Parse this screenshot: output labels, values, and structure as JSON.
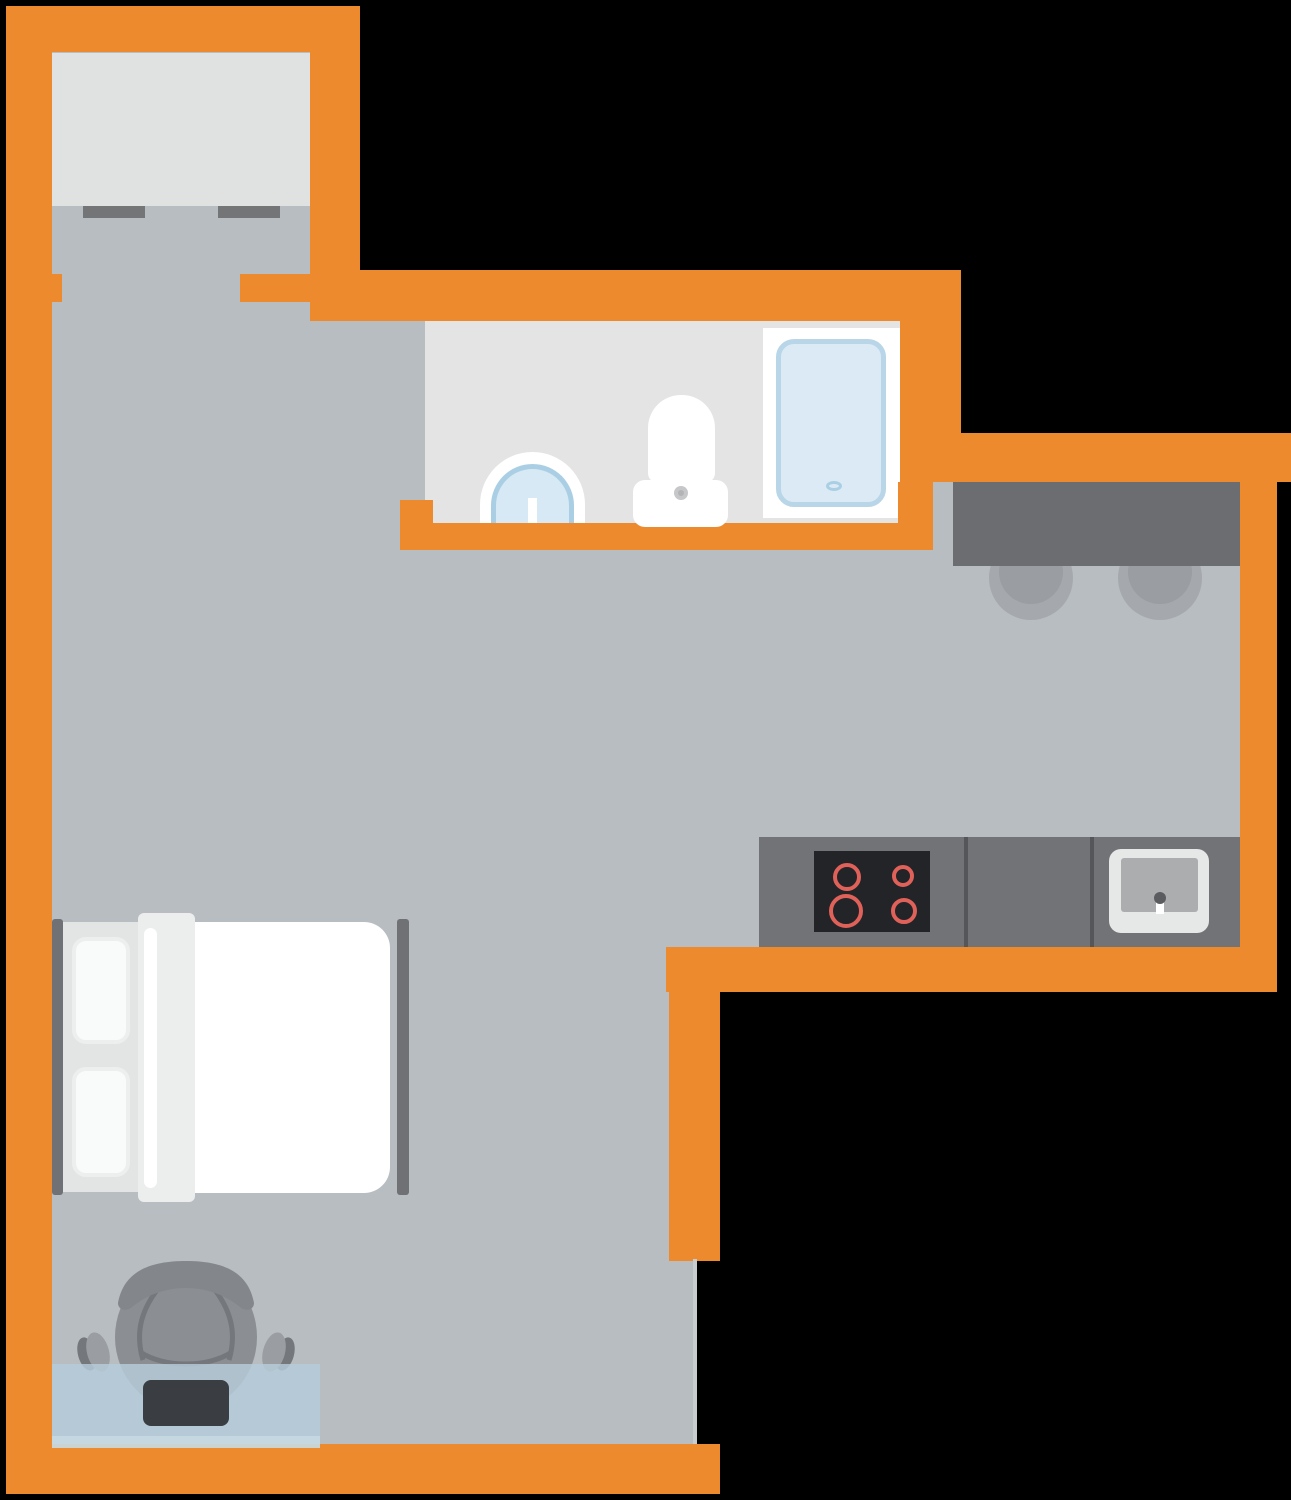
{
  "meta": {
    "title": "studio-apartment-floor-plan",
    "rooms": [
      "entry-closet",
      "living-room",
      "bathroom",
      "kitchen"
    ],
    "furniture": [
      "wardrobe",
      "double-bed",
      "desk",
      "office-chair",
      "laptop",
      "breakfast-bar",
      "bar-stool",
      "bar-stool",
      "kitchen-counter",
      "stove",
      "kitchen-sink",
      "bathroom-sink",
      "toilet",
      "shower"
    ]
  },
  "palette": {
    "wall": "#ED8A2E",
    "floor": "#B8BDC2",
    "bathroom_floor": "#E4E4E4",
    "wardrobe": "#E0E1E1",
    "handle": "#737577",
    "breakfast_bar": "#6B6D70",
    "counter": "#717376",
    "counter_divider": "#54565A",
    "stove": "#222427",
    "burner": "#DF6159",
    "sink_white": "#E6E7E7",
    "basin": "#ACADAF",
    "fixture_white": "#FFFFFF",
    "shower_border": "#B8D6E8",
    "shower_fill": "#DBEAF5",
    "blue_fill": "#D6E9F4",
    "blue_border": "#AACFE4",
    "bed_rail": "#6F7174",
    "sheet": "#E3E4E4",
    "pillow": "#F9FAFA",
    "fold_band": "#ECEDED",
    "desk": "rgba(182,204,218,0.82)",
    "desk_edge": "rgba(199,217,228,0.9)",
    "laptop": "#3A3E42",
    "chair_body": "#8B8E92",
    "chair_dark": "#74777B",
    "chair_headrest": "#83868A",
    "stool_outer": "#A5A9AD",
    "stool_inner": "#9A9EA2",
    "threshold": "#CACDD0",
    "outside": "#000000"
  },
  "scene_bg": [
    {
      "n": "floor-entry",
      "t": "rect",
      "x": 52,
      "y": 52,
      "w": 258,
      "h": 250,
      "f": "#B8BDC2"
    },
    {
      "n": "floor-living",
      "t": "rect",
      "x": 52,
      "y": 302,
      "w": 641,
      "h": 1142,
      "f": "#B8BDC2"
    },
    {
      "n": "floor-bath-corridor",
      "t": "rect",
      "x": 360,
      "y": 321,
      "w": 65,
      "h": 229,
      "f": "#B8BDC2"
    },
    {
      "n": "floor-kitchen",
      "t": "rect",
      "x": 360,
      "y": 550,
      "w": 880,
      "h": 397,
      "f": "#B8BDC2"
    },
    {
      "n": "floor-kitchen-upper",
      "t": "rect",
      "x": 900,
      "y": 482,
      "w": 340,
      "h": 68,
      "f": "#B8BDC2"
    },
    {
      "n": "bathroom-floor",
      "t": "rect",
      "x": 425,
      "y": 321,
      "w": 475,
      "h": 202,
      "f": "#E4E4E4"
    },
    {
      "n": "shower-frame",
      "t": "rect",
      "x": 763,
      "y": 328,
      "w": 137,
      "h": 190,
      "f": "#FFFFFF"
    },
    {
      "n": "shower-tray",
      "t": "rect",
      "x": 776,
      "y": 339,
      "w": 110,
      "h": 168,
      "f": "#DBEAF5",
      "b": "5px solid #B8D6E8",
      "r": "18px"
    },
    {
      "n": "shower-drain",
      "t": "rect",
      "x": 826,
      "y": 481,
      "w": 16,
      "h": 10,
      "f": "#DBEAF5",
      "b": "3px solid #AACFE4",
      "r": "50%"
    },
    {
      "n": "wardrobe",
      "t": "rect",
      "x": 52,
      "y": 53,
      "w": 258,
      "h": 153,
      "f": "#E0E1E1"
    },
    {
      "n": "wall-top",
      "t": "rect",
      "x": 6,
      "y": 6,
      "w": 354,
      "h": 46,
      "f": "#ED8A2E"
    },
    {
      "n": "wall-left",
      "t": "rect",
      "x": 6,
      "y": 6,
      "w": 46,
      "h": 1488,
      "f": "#ED8A2E"
    },
    {
      "n": "wall-bottom",
      "t": "rect",
      "x": 6,
      "y": 1444,
      "w": 714,
      "h": 50,
      "f": "#ED8A2E"
    },
    {
      "n": "wall-entry-right",
      "t": "rect",
      "x": 310,
      "y": 6,
      "w": 50,
      "h": 266,
      "f": "#ED8A2E"
    },
    {
      "n": "wall-bathroom-top",
      "t": "rect",
      "x": 310,
      "y": 270,
      "w": 651,
      "h": 51,
      "f": "#ED8A2E"
    },
    {
      "n": "door-jamb-left",
      "t": "rect",
      "x": 52,
      "y": 274,
      "w": 10,
      "h": 28,
      "f": "#ED8A2E"
    },
    {
      "n": "door-jamb-entry",
      "t": "rect",
      "x": 240,
      "y": 274,
      "w": 70,
      "h": 28,
      "f": "#ED8A2E"
    },
    {
      "n": "wall-bathroom-right",
      "t": "rect",
      "x": 900,
      "y": 271,
      "w": 61,
      "h": 211,
      "f": "#ED8A2E"
    },
    {
      "n": "wall-kitchen-top",
      "t": "rect",
      "x": 900,
      "y": 433,
      "w": 391,
      "h": 49,
      "f": "#ED8A2E"
    },
    {
      "n": "wall-bathroom-pillar",
      "t": "rect",
      "x": 898,
      "y": 482,
      "w": 35,
      "h": 68,
      "f": "#ED8A2E"
    },
    {
      "n": "door-jamb-bathroom",
      "t": "rect",
      "x": 400,
      "y": 500,
      "w": 33,
      "h": 50,
      "f": "#ED8A2E"
    },
    {
      "n": "wall-bathroom-bottom",
      "t": "rect",
      "x": 400,
      "y": 523,
      "w": 533,
      "h": 27,
      "f": "#ED8A2E"
    },
    {
      "n": "wall-kitchen-right",
      "t": "rect",
      "x": 1240,
      "y": 482,
      "w": 37,
      "h": 510,
      "f": "#ED8A2E"
    },
    {
      "n": "wall-kitchen-bottom",
      "t": "rect",
      "x": 666,
      "y": 947,
      "w": 611,
      "h": 45,
      "f": "#ED8A2E"
    },
    {
      "n": "wall-living-right",
      "t": "rect",
      "x": 669,
      "y": 947,
      "w": 51,
      "h": 314,
      "f": "#ED8A2E"
    },
    {
      "n": "entry-door-threshold",
      "t": "rect",
      "x": 693,
      "y": 1259,
      "w": 4,
      "h": 185,
      "f": "#CACDD0"
    },
    {
      "n": "wardrobe-handle-left",
      "t": "rect",
      "x": 83,
      "y": 206,
      "w": 62,
      "h": 12,
      "f": "#737577"
    },
    {
      "n": "wardrobe-handle-right",
      "t": "rect",
      "x": 218,
      "y": 206,
      "w": 62,
      "h": 12,
      "f": "#737577"
    },
    {
      "n": "bed-rail-left",
      "t": "rect",
      "x": 52,
      "y": 919,
      "w": 11,
      "h": 276,
      "f": "#6F7174",
      "r": "3px"
    },
    {
      "n": "bed-sheet",
      "t": "rect",
      "x": 63,
      "y": 922,
      "w": 75,
      "h": 270,
      "f": "#E3E4E4"
    },
    {
      "n": "bed-pillow-top",
      "t": "rect",
      "x": 72,
      "y": 937,
      "w": 58,
      "h": 107,
      "f": "#F9FAFA",
      "b": "4px solid #EDEEEE",
      "r": "14px"
    },
    {
      "n": "bed-pillow-bottom",
      "t": "rect",
      "x": 72,
      "y": 1067,
      "w": 58,
      "h": 110,
      "f": "#F9FAFA",
      "b": "4px solid #EDEEEE",
      "r": "14px"
    },
    {
      "n": "bed-mattress",
      "t": "rect",
      "x": 195,
      "y": 922,
      "w": 195,
      "h": 271,
      "f": "#FFFFFF",
      "r": "0 26px 26px 0"
    },
    {
      "n": "bed-fold-band",
      "t": "rect",
      "x": 138,
      "y": 913,
      "w": 57,
      "h": 289,
      "f": "#ECEDED",
      "r": "6px"
    },
    {
      "n": "bed-fold-stripe",
      "t": "rect",
      "x": 144,
      "y": 928,
      "w": 13,
      "h": 260,
      "f": "#FFFFFF",
      "r": "7px"
    },
    {
      "n": "bed-rail-right",
      "t": "rect",
      "x": 397,
      "y": 919,
      "w": 12,
      "h": 276,
      "f": "#6F7174",
      "r": "3px"
    }
  ],
  "scene_fg": [
    {
      "n": "desk",
      "t": "rect",
      "x": 52,
      "y": 1364,
      "w": 268,
      "h": 72,
      "f": "rgba(182,204,218,0.82)"
    },
    {
      "n": "desk-front-edge",
      "t": "rect",
      "x": 52,
      "y": 1436,
      "w": 268,
      "h": 12,
      "f": "rgba(199,217,228,0.9)"
    },
    {
      "n": "laptop",
      "t": "rect",
      "x": 143,
      "y": 1380,
      "w": 86,
      "h": 46,
      "f": "#3A3E42",
      "r": "8px"
    },
    {
      "n": "bar-stool-left-outer",
      "t": "circle",
      "cx": 1031,
      "cy": 578,
      "rad": 42,
      "f": "#A5A9AD"
    },
    {
      "n": "bar-stool-left-inner",
      "t": "circle",
      "cx": 1031,
      "cy": 572,
      "rad": 32,
      "f": "#9A9EA2"
    },
    {
      "n": "bar-stool-right-outer",
      "t": "circle",
      "cx": 1160,
      "cy": 578,
      "rad": 42,
      "f": "#A5A9AD"
    },
    {
      "n": "bar-stool-right-inner",
      "t": "circle",
      "cx": 1160,
      "cy": 572,
      "rad": 32,
      "f": "#9A9EA2"
    },
    {
      "n": "breakfast-bar",
      "t": "rect",
      "x": 953,
      "y": 482,
      "w": 287,
      "h": 84,
      "f": "#6B6D70"
    },
    {
      "n": "kitchen-counter",
      "t": "rect",
      "x": 759,
      "y": 837,
      "w": 481,
      "h": 110,
      "f": "#717376"
    },
    {
      "n": "counter-divider-1",
      "t": "rect",
      "x": 964,
      "y": 837,
      "w": 4,
      "h": 110,
      "f": "#54565A"
    },
    {
      "n": "counter-divider-2",
      "t": "rect",
      "x": 1090,
      "y": 837,
      "w": 4,
      "h": 110,
      "f": "#54565A"
    },
    {
      "n": "stove",
      "t": "rect",
      "x": 814,
      "y": 851,
      "w": 116,
      "h": 81,
      "f": "#222427"
    },
    {
      "n": "burner-top-left",
      "t": "ring",
      "cx": 847,
      "cy": 877,
      "rad": 14,
      "b": "4px solid #DF6159"
    },
    {
      "n": "burner-top-right",
      "t": "ring",
      "cx": 903,
      "cy": 876,
      "rad": 11,
      "b": "4px solid #DF6159"
    },
    {
      "n": "burner-bottom-left",
      "t": "ring",
      "cx": 846,
      "cy": 911,
      "rad": 17,
      "b": "4px solid #DF6159"
    },
    {
      "n": "burner-bottom-right",
      "t": "ring",
      "cx": 904,
      "cy": 911,
      "rad": 13,
      "b": "4px solid #DF6159"
    },
    {
      "n": "kitchen-sink",
      "t": "rect",
      "x": 1109,
      "y": 849,
      "w": 100,
      "h": 84,
      "f": "#E6E7E7",
      "r": "12px"
    },
    {
      "n": "kitchen-sink-basin",
      "t": "rect",
      "x": 1121,
      "y": 858,
      "w": 77,
      "h": 54,
      "f": "#ACADAF",
      "r": "3px"
    },
    {
      "n": "kitchen-faucet-stem",
      "t": "rect",
      "x": 1156,
      "y": 898,
      "w": 8,
      "h": 16,
      "f": "#FFFFFF"
    },
    {
      "n": "kitchen-faucet-dot",
      "t": "circle",
      "cx": 1160,
      "cy": 898,
      "rad": 6,
      "f": "#5A5C60"
    },
    {
      "n": "bathroom-sink",
      "t": "rect",
      "x": 480,
      "y": 452,
      "w": 105,
      "h": 71,
      "f": "#FFFFFF",
      "r": "105px 105px 0 0"
    },
    {
      "n": "bathroom-sink-bowl",
      "t": "rect",
      "x": 491,
      "y": 464,
      "w": 83,
      "h": 59,
      "f": "#D6E9F4",
      "b": "5px solid #AACFE4",
      "bb": "none",
      "r": "83px 83px 0 0"
    },
    {
      "n": "bathroom-sink-tap",
      "t": "rect",
      "x": 528,
      "y": 498,
      "w": 9,
      "h": 25,
      "f": "#FFFFFF"
    },
    {
      "n": "toilet-bowl",
      "t": "rect",
      "x": 648,
      "y": 395,
      "w": 67,
      "h": 88,
      "f": "#FFFFFF",
      "r": "33px 33px 10px 10px"
    },
    {
      "n": "toilet-tank",
      "t": "rect",
      "x": 633,
      "y": 480,
      "w": 95,
      "h": 47,
      "f": "#FFFFFF",
      "r": "12px"
    },
    {
      "n": "toilet-flush-button",
      "t": "circle",
      "cx": 681,
      "cy": 493,
      "rad": 7,
      "f": "#C6C7C9"
    },
    {
      "n": "toilet-flush-button-center",
      "t": "circle",
      "cx": 681,
      "cy": 493,
      "rad": 3,
      "f": "#B3B4B6"
    }
  ]
}
